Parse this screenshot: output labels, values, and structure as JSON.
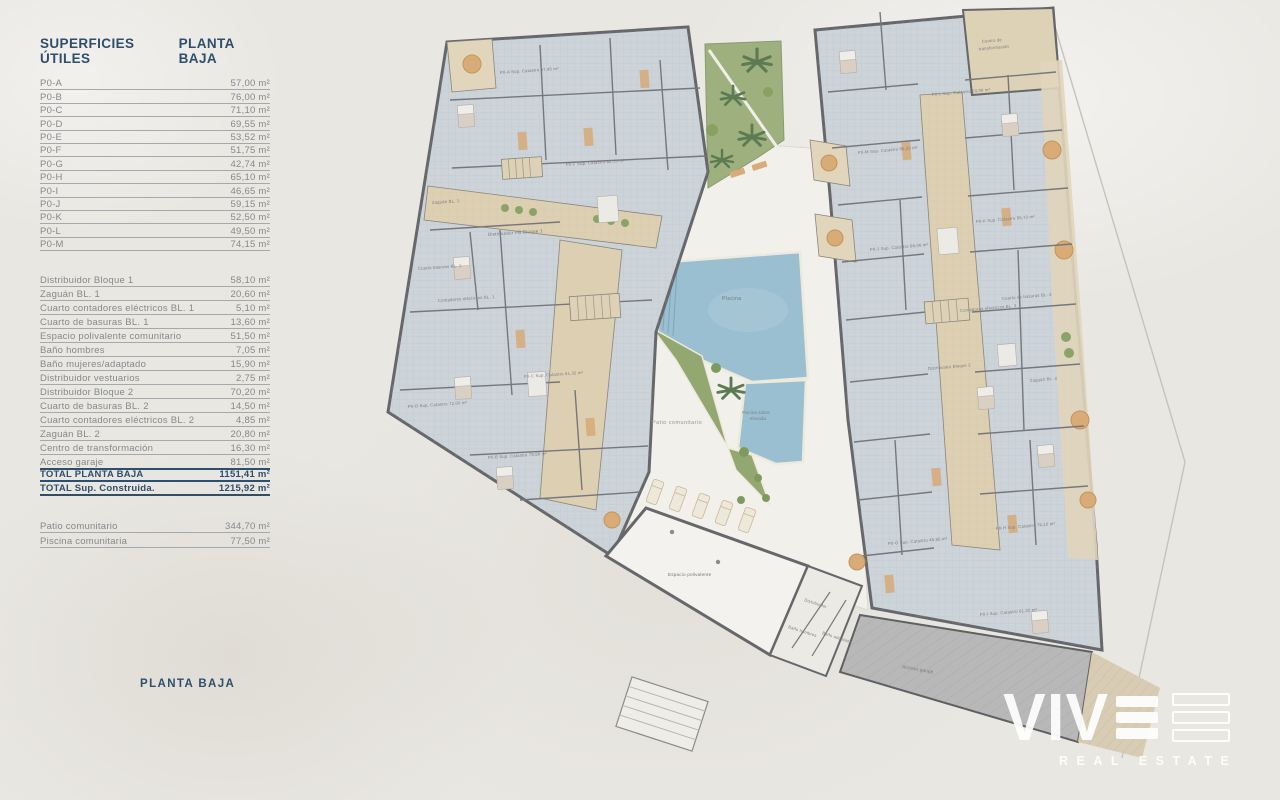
{
  "panel": {
    "header": {
      "col1": "SUPERFICIES ÚTILES",
      "col2": "PLANTA BAJA"
    },
    "units": [
      {
        "label": "P0-A",
        "value": "57,00 m²"
      },
      {
        "label": "P0-B",
        "value": "76,00 m²"
      },
      {
        "label": "P0-C",
        "value": "71,10 m²"
      },
      {
        "label": "P0-D",
        "value": "69,55 m²"
      },
      {
        "label": "P0-E",
        "value": "53,52 m²"
      },
      {
        "label": "P0-F",
        "value": "51,75 m²"
      },
      {
        "label": "P0-G",
        "value": "42,74 m²"
      },
      {
        "label": "P0-H",
        "value": "65,10 m²"
      },
      {
        "label": "P0-I",
        "value": "46,65 m²"
      },
      {
        "label": "P0-J",
        "value": "59,15 m²"
      },
      {
        "label": "P0-K",
        "value": "52,50 m²"
      },
      {
        "label": "P0-L",
        "value": "49,50 m²"
      },
      {
        "label": "P0-M",
        "value": "74,15 m²"
      }
    ],
    "common": [
      {
        "label": "Distribuidor Bloque 1",
        "value": "58,10 m²"
      },
      {
        "label": "Zaguán BL. 1",
        "value": "20,60 m²"
      },
      {
        "label": "Cuarto contadores eléctricos BL. 1",
        "value": "5,10 m²"
      },
      {
        "label": "Cuarto de basuras BL. 1",
        "value": "13,60 m²"
      },
      {
        "label": "Espacio polivalente comunitario",
        "value": "51,50 m²"
      },
      {
        "label": "Baño hombres",
        "value": "7,05 m²"
      },
      {
        "label": "Baño mujeres/adaptado",
        "value": "15,90 m²"
      },
      {
        "label": "Distribuidor vestuarios",
        "value": "2,75 m²"
      },
      {
        "label": "Distribuidor Bloque 2",
        "value": "70,20 m²"
      },
      {
        "label": "Cuarto de basuras BL. 2",
        "value": "14,50 m²"
      },
      {
        "label": "Cuarto contadores eléctricos BL. 2",
        "value": "4,85 m²"
      },
      {
        "label": "Zaguán BL. 2",
        "value": "20,80 m²"
      },
      {
        "label": "Centro de transformación",
        "value": "16,30 m²"
      },
      {
        "label": "Acceso garaje",
        "value": "81,50 m²"
      },
      {
        "label": "TOTAL PLANTA BAJA",
        "value": "1151,41 m²",
        "total": true,
        "topline": true
      },
      {
        "label": "TOTAL Sup. Construida.",
        "value": "1215,92 m²",
        "total": true
      }
    ],
    "outdoor": [
      {
        "label": "Patio comunitario",
        "value": "344,70 m²"
      },
      {
        "label": "Piscina comunitaria",
        "value": "77,50 m²"
      }
    ],
    "footer_label": "PLANTA BAJA"
  },
  "plan": {
    "labels": {
      "zaguan1": "Zaguán BL. 1",
      "distribuidor1": "Distribuidor PB Bloque 1",
      "basuras1": "Cuarto basuras BL. 1",
      "contadores1": "Contadores eléctricos BL. 1",
      "piscina": "Piscina",
      "piscina_elevada_l1": "Piscina sobre",
      "piscina_elevada_l2": "elevada",
      "patio": "Patio comunitario",
      "espacio": "Espacio polivalente",
      "distribuidor_pb": "Distribuidor",
      "bano_hombres": "Baño hombres",
      "bano_adaptado": "Baño adaptado",
      "centro_l1": "Centro de",
      "centro_l2": "transformación",
      "basuras2": "Cuarto de basuras BL. 2",
      "contadores2": "Contadores eléctricos BL. 2",
      "distribuidor2": "Distribuidor Bloque 2",
      "zaguan2": "Zaguán BL. 2",
      "acceso": "Acceso garaje"
    },
    "apartments": [
      {
        "text": "P0-A Sup. Catastro 67,45 m²"
      },
      {
        "text": "P0-F Sup. Catastro 82,10 m²"
      },
      {
        "text": "P0-C Sup. Catastro 81,32 m²"
      },
      {
        "text": "P0-D Sup. Catastro 72,00 m²"
      },
      {
        "text": "P0-B Sup. Catastro 79,80 m²"
      },
      {
        "text": "P0-L Sup. Catastro 53,99 m²"
      },
      {
        "text": "P0-M Sup. Catastro 85,20 m²"
      },
      {
        "text": "P0-K Sup. Catastro 55,73 m²"
      },
      {
        "text": "P0-J Sup. Catastro 66,06 m²"
      },
      {
        "text": "P0-G Sup. Catastro 45,85 m²"
      },
      {
        "text": "P0-H Sup. Catastro 75,10 m²"
      },
      {
        "text": "P0-I Sup. Catastro 61,25 m²"
      }
    ],
    "colors": {
      "accent_navy": "#2f4e6b",
      "wall_gray": "#66676a",
      "floor_blue": "#ccd3d9",
      "corridor_beige": "#dccfb2",
      "terrace_beige": "#e1d5bb",
      "patio_white": "#f2f0eb",
      "pool_blue": "#9abfd0",
      "garden_green": "#9db07e",
      "palm_green": "#5d7b52",
      "ramp_gray": "#b8b8b9",
      "background": "#e9e7e2"
    }
  },
  "logo": {
    "name": "VIVE",
    "name_prefix": "VIV",
    "tagline": "REAL ESTATE"
  }
}
